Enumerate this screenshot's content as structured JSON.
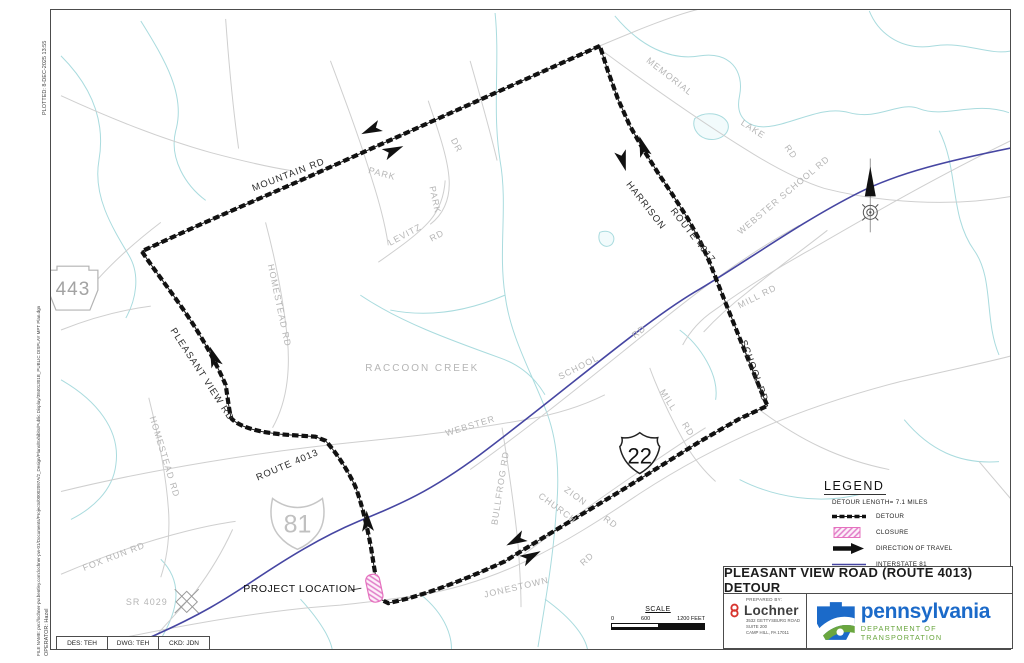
{
  "margin_notes": {
    "plotted": "PLOTTED:   8-DEC-2025 13:55",
    "operator": "OPERATOR: Hazel",
    "file_name": "FILE NAME: pw://lochner-pw.bentley.com:lochner-pw-01/Documents/Projects/00002097A/2_Design/Plans/Exhibits/Public Display/38401301B_PUBLIC DISPLAY MPT Plan.dgn"
  },
  "drawing_block": {
    "des": "DES: TEH",
    "dwg": "DWG: TEH",
    "ckd": "CKD: JDN"
  },
  "map": {
    "labels": {
      "memorial": "MEMORIAL",
      "memorial_lake": "LAKE",
      "memorial_lake_rd": "RD",
      "webster_school_rd": "WEBSTER SCHOOL RD",
      "mill_rd_upper": "MILL RD",
      "park": "PARK",
      "park_dr": "DR",
      "levitz": "LEVITZ",
      "levitz_park": "PARK",
      "levitz_rd": "RD",
      "homestead_rd_upper": "HOMESTEAD RD",
      "homestead_rd_lower": "HOMESTEAD RD",
      "raccoon_creek": "RACCOON CREEK",
      "school": "SCHOOL",
      "school_rd": "RD",
      "webster": "WEBSTER",
      "mill": "MILL",
      "mill_rd": "RD",
      "bullfrog_rd": "BULLFROG RD",
      "zion": "ZION",
      "church": "CHURCH",
      "zion_church_rd": "RD",
      "jonestown": "JONESTOWN",
      "jonestown_rd": "RD",
      "fox_run_rd": "FOX RUN RD",
      "sr_4029": "SR 4029",
      "mountain_rd": "MOUNTAIN RD",
      "pleasant_view_rd": "PLEASANT VIEW RD",
      "route_4013": "ROUTE 4013",
      "harrison": "HARRISON",
      "route_4017": "ROUTE 4017",
      "school_rd_detour": "SCHOOL RD",
      "project_location": "PROJECT LOCATION"
    },
    "shields": {
      "pa443": "443",
      "i81": "81",
      "us22": "22"
    }
  },
  "legend": {
    "title": "LEGEND",
    "detour_length": "DETOUR LENGTH= 7.1 MILES",
    "items": [
      "DETOUR",
      "CLOSURE",
      "DIRECTION OF TRAVEL",
      "INTERSTATE 81"
    ]
  },
  "scale": {
    "title": "SCALE",
    "ticks": [
      "0",
      "600",
      "1200 FEET"
    ]
  },
  "title_block": {
    "title": "PLEASANT VIEW ROAD (ROUTE 4013) DETOUR",
    "prepared_by": "PREPARED BY:",
    "company": "Lochner",
    "address1": "3532 GETTYSBURG ROAD",
    "address2": "SUITE 200",
    "address3": "CAMP HILL, PA 17011",
    "agency": "pennsylvania",
    "agency_sub": "DEPARTMENT OF TRANSPORTATION"
  },
  "colors": {
    "detour": "#111111",
    "interstate": "#4646a2",
    "closure_pink": "#e86cc0",
    "creek": "#a9dbde",
    "road_gray": "#cfcfcf",
    "label_gray": "#b5b5b5",
    "penndot_blue": "#1b6ac9",
    "penndot_green": "#6aa63f",
    "lochner_red": "#d7342e"
  }
}
